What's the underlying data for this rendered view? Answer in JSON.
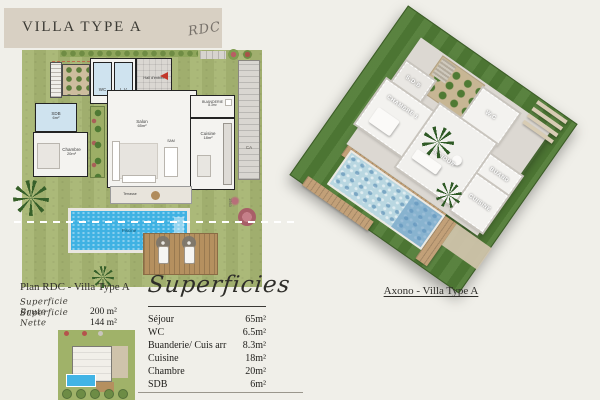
{
  "page": {
    "title": "VILLA TYPE A",
    "annotation": "RDC"
  },
  "plan2d": {
    "caption": "Plan RDC - Villa Type A",
    "metrics": [
      {
        "label": "Superficie Brute",
        "value": "200 m²"
      },
      {
        "label": "Superficie Nette",
        "value": "144 m²"
      }
    ],
    "labels": {
      "wc": "WC",
      "lv": "L.V",
      "hall": "Hall d'entrée",
      "buanderie": "BUANDERIE",
      "buanderie_area": "8.3m²",
      "salon": "Salon",
      "salon_area": "65m²",
      "sam": "SAM",
      "cuisine": "Cuisine",
      "cuisine_area": "18m²",
      "sdb": "SDB",
      "sdb_area": "6m²",
      "chambre": "Chambre",
      "chambre_area": "20m²",
      "terrasse": "Terrasse",
      "piscine": "Piscine",
      "ca": "CA",
      "dim": "1563"
    }
  },
  "superficies": {
    "title": "Superficies",
    "rows": [
      {
        "label": "Séjour",
        "value": "65m²"
      },
      {
        "label": "WC",
        "value": "6.5m²"
      },
      {
        "label": "Buanderie/ Cuis arr",
        "value": "8.3m²"
      },
      {
        "label": "Cuisine",
        "value": "18m²"
      },
      {
        "label": "Chambre",
        "value": "20m²"
      },
      {
        "label": "SDB",
        "value": "6m²"
      }
    ]
  },
  "axono": {
    "caption": "Axono - Villa Type A",
    "labels": {
      "sdb": "S.D.B",
      "chambre": "CHAMBRE 1",
      "wc": "W.C",
      "sejour": "SEJOUR",
      "buand": "BUAND",
      "cuisine": "CUISINE"
    }
  },
  "colors": {
    "background": "#f0efe9",
    "header_beige": "#d8d0c3",
    "lawn_2d": "#a7b572",
    "lawn_3d": "#517c36",
    "pool_2d": "#3fb2e3",
    "pool_3d": "#b9d7e1",
    "wood_deck": "#b5905f",
    "accent_red": "#c2372a",
    "wet_room_blue": "#cfe3ef"
  }
}
